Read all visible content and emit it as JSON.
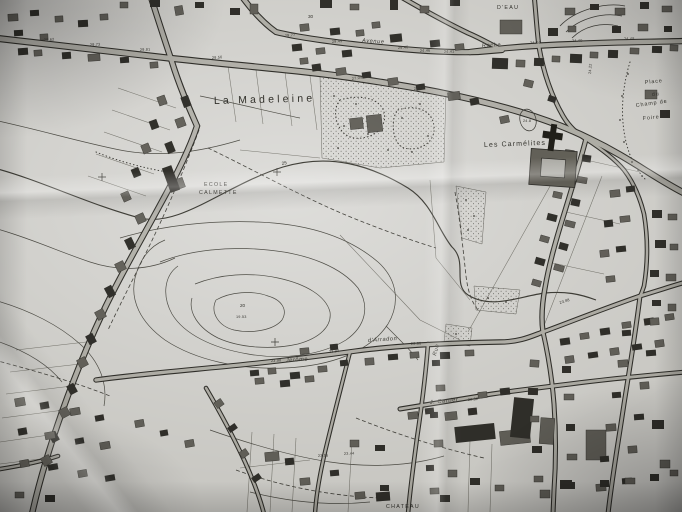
{
  "map": {
    "place_labels": {
      "la_madeleine": "La Madeleine",
      "les_carmelites": "Les Carmélites",
      "ecole_line1": "ECOLE",
      "ecole_line2": "CALMETTE",
      "d_eau": "D'EAU",
      "chateau": "CHATEAU",
      "place_line1": "Place",
      "place_line2": "du",
      "place_line3": "Champ de",
      "place_line4": "Foire"
    },
    "street_labels": {
      "avenue": "Avenue",
      "roche": "Roche",
      "jerome": "Jerôme",
      "arradon": "d'Arradon",
      "cartier": "J. Cartier",
      "rue": "Rue"
    },
    "elevations": [
      "29.62",
      "29.73",
      "29.81",
      "29.56",
      "29.77",
      "30",
      "29.45",
      "29.46",
      "24.46",
      "24.41",
      "27.04",
      "27.12",
      "24.44",
      "24.40",
      "24.48",
      "24.22",
      "24.8",
      "25",
      "23.98",
      "23.94",
      "23.90",
      "23.88",
      "23.52",
      "23.56",
      "23.44",
      "20",
      "19.53"
    ],
    "colors": {
      "paper": "#c8c7c2",
      "road_fill": "#d6d5d0",
      "ink": "#3a3934",
      "building_dark": "#3b3a35",
      "building_mid": "#787670",
      "contour": "#5e5d56"
    }
  }
}
